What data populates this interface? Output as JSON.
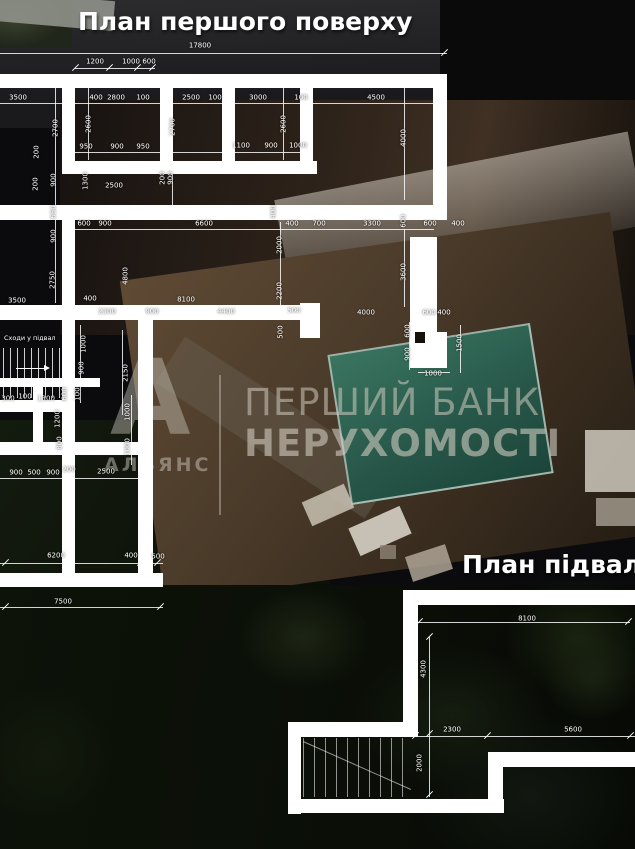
{
  "titles": {
    "first_floor": "План першого поверху",
    "basement": "План підвалу"
  },
  "watermark": {
    "line1": "ПЕРШИЙ БАНК",
    "line2": "НЕРУХОМОСТІ",
    "logo_letter": "А",
    "logo_text": "АЛЬЯНС"
  },
  "labels": {
    "stairs": "Сходи у підвал"
  },
  "colors": {
    "wall": "#ffffff",
    "dim_text": "#ffffff",
    "pool": "#2c6553",
    "watermark": "#c9c3b8"
  },
  "first_floor_dims": [
    {
      "t": "17800",
      "x": 200,
      "y": 46
    },
    {
      "t": "1200",
      "x": 95,
      "y": 62
    },
    {
      "t": "1000",
      "x": 131,
      "y": 62
    },
    {
      "t": "600",
      "x": 149,
      "y": 62
    },
    {
      "t": "3500",
      "x": 18,
      "y": 98
    },
    {
      "t": "400",
      "x": 96,
      "y": 98
    },
    {
      "t": "2800",
      "x": 116,
      "y": 98
    },
    {
      "t": "100",
      "x": 143,
      "y": 98
    },
    {
      "t": "2500",
      "x": 191,
      "y": 98
    },
    {
      "t": "100",
      "x": 215,
      "y": 98
    },
    {
      "t": "3000",
      "x": 258,
      "y": 98
    },
    {
      "t": "100",
      "x": 301,
      "y": 98
    },
    {
      "t": "4500",
      "x": 376,
      "y": 98
    },
    {
      "t": "2700",
      "x": 56,
      "y": 128,
      "r": 1
    },
    {
      "t": "2600",
      "x": 89,
      "y": 124,
      "r": 1
    },
    {
      "t": "2700",
      "x": 173,
      "y": 127,
      "r": 1
    },
    {
      "t": "2600",
      "x": 284,
      "y": 124,
      "r": 1
    },
    {
      "t": "4000",
      "x": 404,
      "y": 138,
      "r": 1
    },
    {
      "t": "950",
      "x": 86,
      "y": 147
    },
    {
      "t": "900",
      "x": 117,
      "y": 147
    },
    {
      "t": "950",
      "x": 143,
      "y": 147
    },
    {
      "t": "1100",
      "x": 241,
      "y": 146
    },
    {
      "t": "900",
      "x": 271,
      "y": 146
    },
    {
      "t": "1000",
      "x": 298,
      "y": 146
    },
    {
      "t": "200",
      "x": 37,
      "y": 152,
      "r": 1
    },
    {
      "t": "900",
      "x": 54,
      "y": 180,
      "r": 1
    },
    {
      "t": "200",
      "x": 36,
      "y": 184,
      "r": 1
    },
    {
      "t": "650",
      "x": 54,
      "y": 212,
      "r": 1
    },
    {
      "t": "900",
      "x": 54,
      "y": 236,
      "r": 1
    },
    {
      "t": "1300",
      "x": 86,
      "y": 181,
      "r": 1
    },
    {
      "t": "2500",
      "x": 114,
      "y": 186
    },
    {
      "t": "200",
      "x": 163,
      "y": 178,
      "r": 1
    },
    {
      "t": "900",
      "x": 171,
      "y": 178,
      "r": 1
    },
    {
      "t": "2750",
      "x": 53,
      "y": 280,
      "r": 1
    },
    {
      "t": "3500",
      "x": 17,
      "y": 301
    },
    {
      "t": "600",
      "x": 84,
      "y": 224
    },
    {
      "t": "900",
      "x": 105,
      "y": 224
    },
    {
      "t": "6600",
      "x": 204,
      "y": 224
    },
    {
      "t": "400",
      "x": 274,
      "y": 212,
      "r": 1
    },
    {
      "t": "400",
      "x": 292,
      "y": 224
    },
    {
      "t": "700",
      "x": 319,
      "y": 224
    },
    {
      "t": "3300",
      "x": 372,
      "y": 224
    },
    {
      "t": "600",
      "x": 430,
      "y": 224
    },
    {
      "t": "400",
      "x": 458,
      "y": 224
    },
    {
      "t": "600",
      "x": 404,
      "y": 221,
      "r": 1
    },
    {
      "t": "2000",
      "x": 280,
      "y": 245,
      "r": 1
    },
    {
      "t": "2200",
      "x": 280,
      "y": 291,
      "r": 1
    },
    {
      "t": "3600",
      "x": 404,
      "y": 272,
      "r": 1
    },
    {
      "t": "4800",
      "x": 126,
      "y": 276,
      "r": 1
    },
    {
      "t": "400",
      "x": 90,
      "y": 299
    },
    {
      "t": "8100",
      "x": 186,
      "y": 300
    },
    {
      "t": "2300",
      "x": 107,
      "y": 312
    },
    {
      "t": "900",
      "x": 152,
      "y": 312
    },
    {
      "t": "4400",
      "x": 226,
      "y": 312
    },
    {
      "t": "500",
      "x": 294,
      "y": 311
    },
    {
      "t": "500",
      "x": 281,
      "y": 332,
      "r": 1
    },
    {
      "t": "4000",
      "x": 366,
      "y": 313
    },
    {
      "t": "600",
      "x": 429,
      "y": 313
    },
    {
      "t": "400",
      "x": 444,
      "y": 313
    },
    {
      "t": "600",
      "x": 408,
      "y": 331,
      "r": 1
    },
    {
      "t": "900",
      "x": 408,
      "y": 354,
      "r": 1
    },
    {
      "t": "1500",
      "x": 460,
      "y": 343,
      "r": 1
    },
    {
      "t": "1000",
      "x": 433,
      "y": 374
    },
    {
      "t": "1000",
      "x": 84,
      "y": 344,
      "r": 1
    },
    {
      "t": "900",
      "x": 82,
      "y": 368,
      "r": 1
    },
    {
      "t": "100",
      "x": 78,
      "y": 394,
      "r": 1
    },
    {
      "t": "2150",
      "x": 126,
      "y": 373,
      "r": 1
    },
    {
      "t": "1000",
      "x": 128,
      "y": 412,
      "r": 1
    },
    {
      "t": "1000",
      "x": 128,
      "y": 447,
      "r": 1
    },
    {
      "t": "300",
      "x": 8,
      "y": 399
    },
    {
      "t": "100",
      "x": 25,
      "y": 397
    },
    {
      "t": "1300",
      "x": 46,
      "y": 399
    },
    {
      "t": "600",
      "x": 65,
      "y": 394,
      "r": 1
    },
    {
      "t": "1200",
      "x": 58,
      "y": 419,
      "r": 1
    },
    {
      "t": "800",
      "x": 60,
      "y": 443,
      "r": 1
    },
    {
      "t": "900",
      "x": 16,
      "y": 473
    },
    {
      "t": "500",
      "x": 34,
      "y": 473
    },
    {
      "t": "900",
      "x": 53,
      "y": 473
    },
    {
      "t": "200",
      "x": 69,
      "y": 470
    },
    {
      "t": "2500",
      "x": 106,
      "y": 472
    },
    {
      "t": "6200",
      "x": 56,
      "y": 556
    },
    {
      "t": "400",
      "x": 131,
      "y": 556
    },
    {
      "t": "500",
      "x": 158,
      "y": 557
    },
    {
      "t": "7500",
      "x": 63,
      "y": 602
    }
  ],
  "basement_dims": [
    {
      "t": "8100",
      "x": 527,
      "y": 619
    },
    {
      "t": "4300",
      "x": 424,
      "y": 669,
      "r": 1
    },
    {
      "t": "2300",
      "x": 452,
      "y": 730
    },
    {
      "t": "5600",
      "x": 573,
      "y": 730
    },
    {
      "t": "2000",
      "x": 420,
      "y": 763,
      "r": 1
    }
  ]
}
